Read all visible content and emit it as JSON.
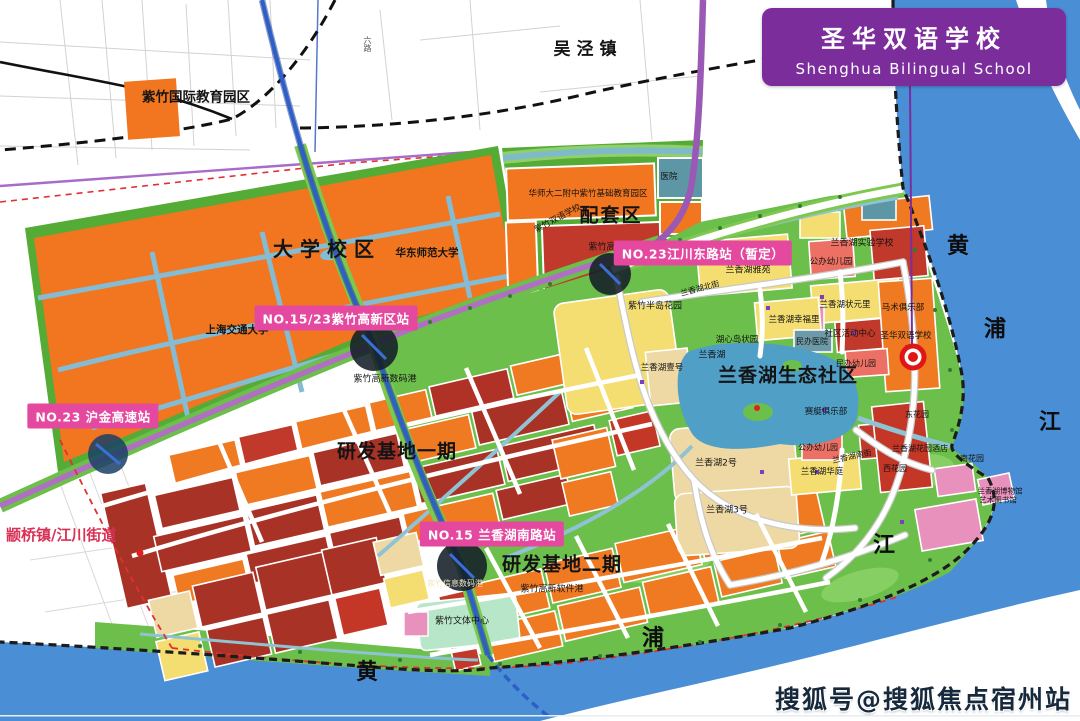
{
  "banner": {
    "title_zh": "圣华双语学校",
    "title_en": "Shenghua Bilingual School"
  },
  "watermark": {
    "text": "搜狐号@搜狐焦点宿州站"
  },
  "badges": {
    "jiangchuan_east": "NO.23江川东路站（暂定）",
    "hi_tech": "NO.15/23紫竹高新区站",
    "hujin": "NO.23 沪金高速站",
    "lxh_south": "NO.15 兰香湖南路站"
  },
  "labels": {
    "zizhu_intl": "紫竹国际教育园区",
    "wujing": "吴泾镇",
    "univ": "大学校区",
    "ecnu": "华东师范大学",
    "sjtu": "上海交通大学",
    "peitao": "配套区",
    "hsd": "华师大二附中紫竹基础教育园区",
    "zz_bilingual": "紫竹双语学校",
    "hospital": "医院",
    "jinrong": "紫竹高新金融港",
    "rd1": "研发基地一期",
    "rd2": "研发基地二期",
    "eco": "兰香湖生态社区",
    "zhuanqiao": "颛桥镇/江川街道",
    "bandao": "紫竹半岛花园",
    "north_st": "兰香湖北街",
    "yayuan": "兰香湖雅苑",
    "kg_north": "公办幼儿园",
    "exp_school": "兰香湖实验学校",
    "equestrian": "马术俱乐部",
    "zhuangyuan": "兰香湖状元里",
    "xingfu": "兰香湖幸福里",
    "comm_center": "社区活动中心",
    "private_hospital": "民办医院",
    "shenghua_map": "圣华双语学校",
    "kg_east": "民办幼儿园",
    "island": "湖心岛状园",
    "lake": "兰香湖",
    "no1": "兰香湖壹号",
    "rowing": "赛艇俱乐部",
    "kg_south": "公办幼儿园",
    "south_st": "兰香湖南街",
    "no2": "兰香湖2号",
    "huating": "兰香湖华庭",
    "west_garden": "西花园",
    "east_garden": "东花园",
    "no3": "兰香湖3号",
    "hotel": "兰香湖花园酒店",
    "south_garden": "南花园",
    "museum": "兰香湖博物馆",
    "art_lib": "艺术图书馆",
    "digital_port": "紫竹高新数码港",
    "software_port": "紫竹高新软件港",
    "info_port": "紫竹信息数码港",
    "wenti": "紫竹文体中心",
    "liu_road": "六路"
  },
  "river": {
    "bottom": [
      "黄",
      "浦",
      "江"
    ],
    "right": [
      "黄",
      "浦",
      "江"
    ]
  },
  "colors": {
    "banner_purple": "#7c2d9c",
    "badge_pink": "#e5489f",
    "river_blue": "#4a8ed6",
    "campus_orange": "#f1761f",
    "eco_green": "#6cbf4a",
    "parcel_darkred": "#a93226",
    "parcel_yellow": "#f4de71",
    "boundary_red": "#e03030",
    "metro_blue": "#2e5fc7",
    "road_purple": "#9b59b6"
  }
}
